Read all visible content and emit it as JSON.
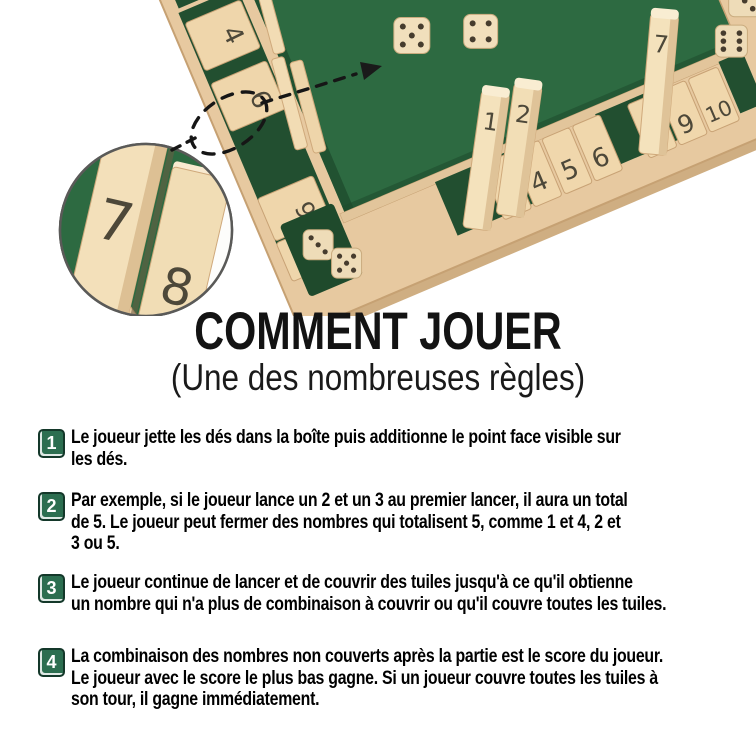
{
  "title": "COMMENT JOUER",
  "subtitle": "(Une des nombreuses règles)",
  "steps": [
    {
      "number": "1",
      "lines": [
        "Le joueur jette les dés dans la boîte puis additionne le point face visible sur",
        "les dés."
      ]
    },
    {
      "number": "2",
      "lines": [
        "Par exemple, si le joueur lance un 2 et un 3 au premier lancer, il aura un total",
        "de 5. Le joueur peut fermer des nombres qui totalisent 5, comme 1 et 4, 2 et",
        "3 ou 5."
      ]
    },
    {
      "number": "3",
      "lines": [
        "Le joueur continue de lancer et de couvrir des tuiles jusqu'à ce qu'il obtienne",
        "un nombre qui n'a plus de combinaison à couvrir ou qu'il couvre toutes les tuiles."
      ]
    },
    {
      "number": "4",
      "lines": [
        "La combinaison des nombres non couverts après la partie est le score du joueur.",
        "Le joueur avec le score le plus bas gagne. Si un joueur couvre toutes les tuiles à",
        "son tour, il gagne immédiatement."
      ]
    }
  ],
  "photo": {
    "inset_tiles": [
      "7",
      "8"
    ],
    "board_tiles": {
      "left_rail": [
        "4",
        "6",
        "9",
        "10"
      ],
      "standing_left": [
        "1",
        "2"
      ],
      "flat_left": [
        "3",
        "4",
        "5",
        "6"
      ],
      "standing_right": "7",
      "flat_right": [
        "8",
        "9",
        "10"
      ]
    }
  },
  "colors": {
    "badge_green": "#2c6e50",
    "felt_green": "#2d6a41",
    "wood_light": "#e7c9a0",
    "tile_wood": "#f2dcb2"
  }
}
